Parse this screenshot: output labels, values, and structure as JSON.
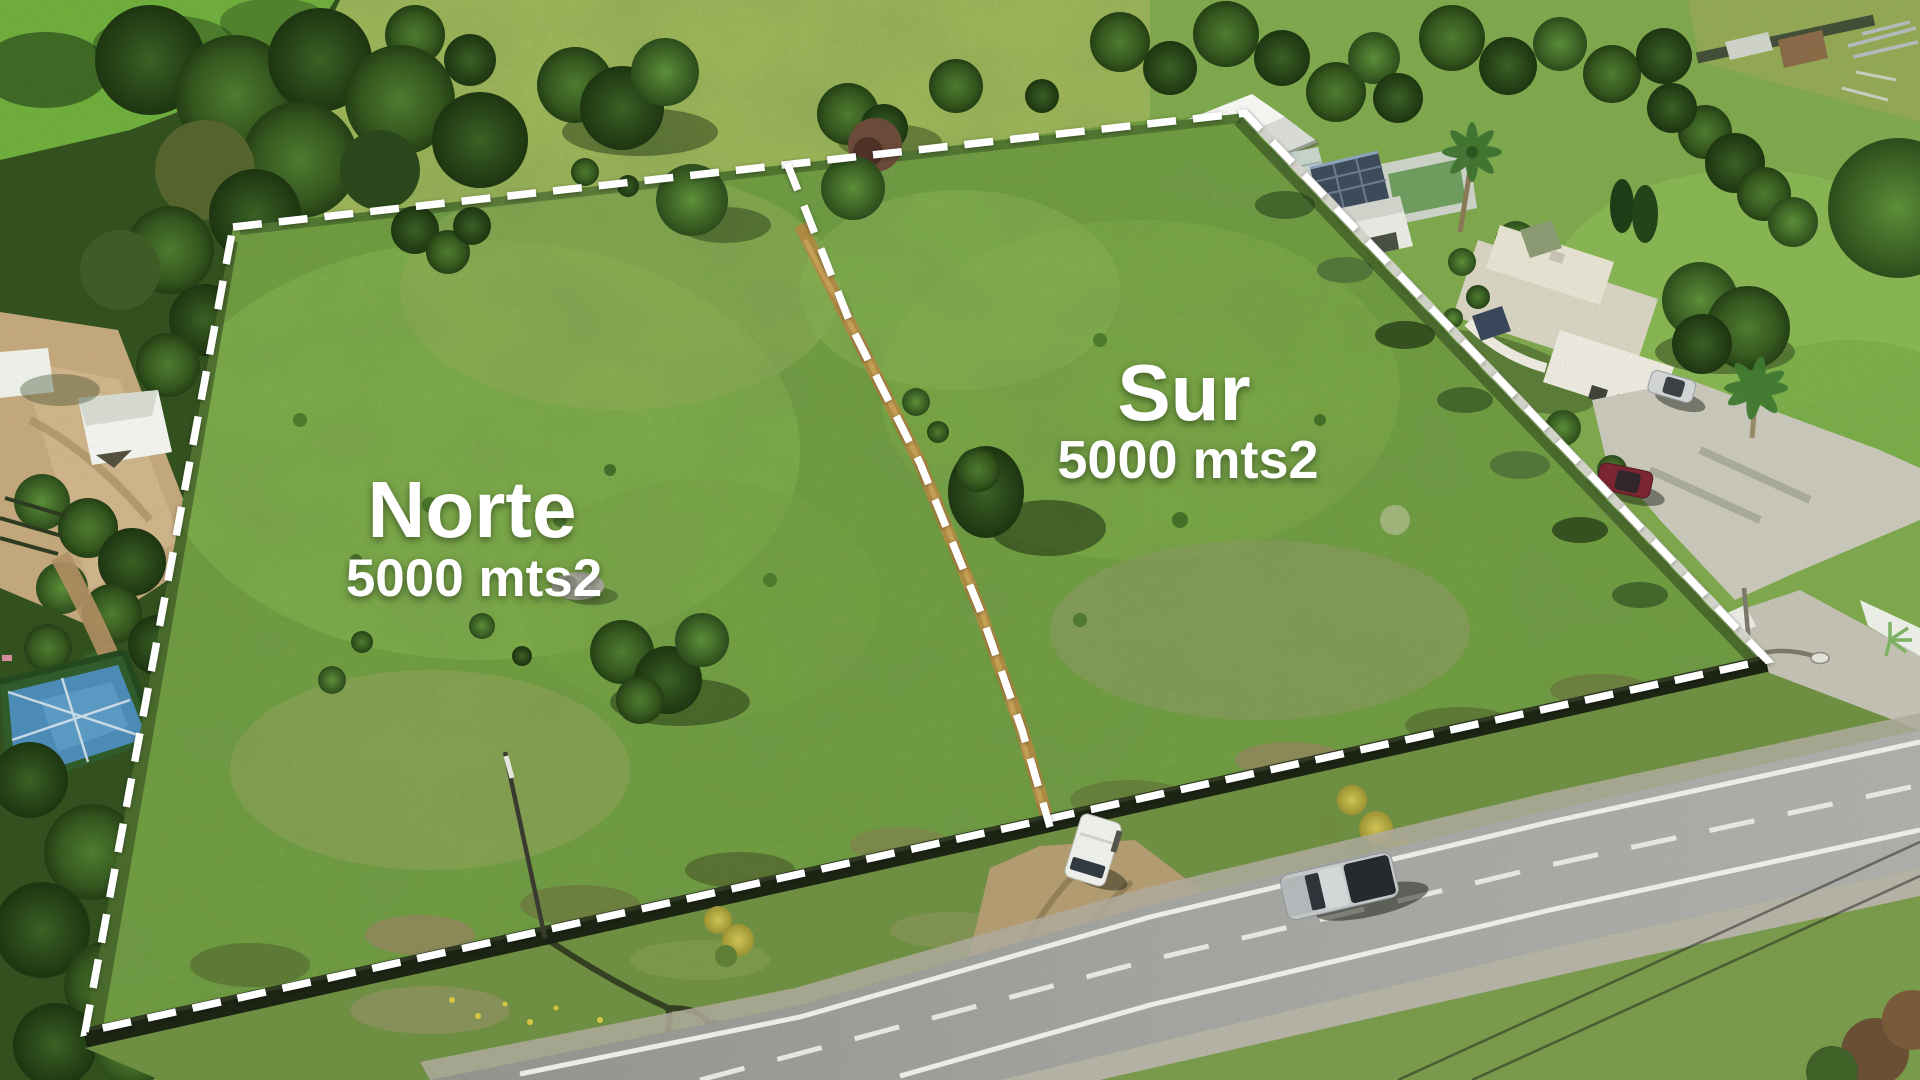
{
  "annotations": {
    "north_parcel": {
      "label": "Norte",
      "area": "5000 mts2"
    },
    "south_parcel": {
      "label": "Sur",
      "area": "5000 mts2"
    }
  },
  "overlay": {
    "boundary_color": "#ffffff",
    "label_color": "#ffffff"
  }
}
